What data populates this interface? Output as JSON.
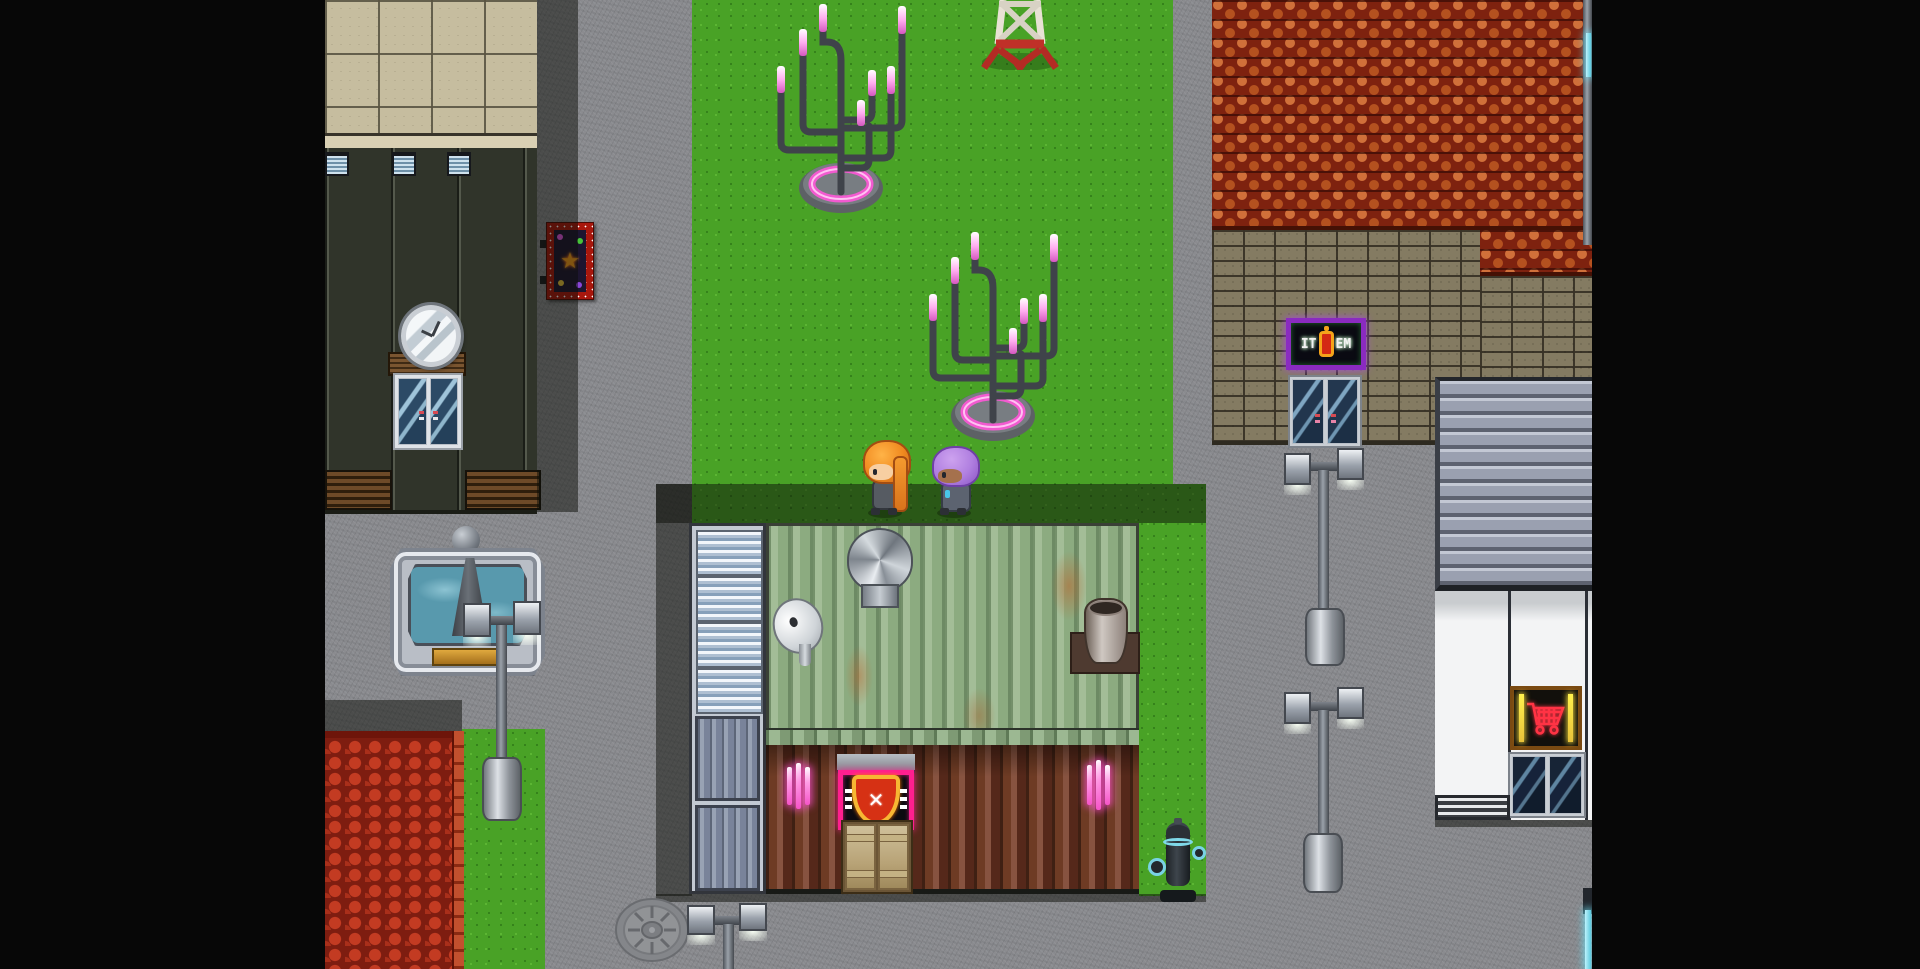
{
  "scene_title": "rpg-town-street-scene",
  "viewport": {
    "left_px": 325,
    "width_px": 1267,
    "height_px": 969
  },
  "colors": {
    "letterbox": "#070707",
    "road": "#8a8b8f",
    "grass": "#49a226",
    "shadow": "rgba(12,14,8,0.5)",
    "tan_roof": "#c6bd9f",
    "dark_wall": "#30342a",
    "orange_roof": "#b4511f",
    "brick": "#847b62",
    "green_metal": "#93ae88",
    "rust_metal": "#5e3220",
    "red_roof": "#a02516",
    "awning": "#9aa0b0",
    "shop_wall": "#f3f4f5",
    "water": "#5899ad",
    "neon_pink": "#ff57d8",
    "neon_cyan": "#7fdef0",
    "neon_magenta": "#ff1f8f",
    "neon_red": "#ff3344",
    "neon_yellow": "#e8c23a",
    "neon_purple": "#8a2bc0"
  },
  "signs": {
    "item_shop": {
      "text_left": "IT",
      "text_right": "EM",
      "description": "neon item-shop sign with potion bottle"
    },
    "guild_banner": {
      "glyph": "✕",
      "description": "pink neon banner with orange shield and white X"
    },
    "billboard": {
      "glyph": "★",
      "description": "red dotted billboard with orange star"
    },
    "market": {
      "icon": "shopping-cart-icon",
      "description": "red neon cart sign with yellow tubes"
    }
  },
  "characters": [
    {
      "id": "orange-haired-girl",
      "hair_color": "#f08a1f",
      "skin_color": "#f7cfa2",
      "outfit_color": "#565b62"
    },
    {
      "id": "purple-haired-girl",
      "hair_color": "#b07fe0",
      "skin_color": "#a5714d",
      "outfit_color": "#5c6370"
    }
  ],
  "props": [
    "candelabra-street-light-1",
    "candelabra-street-light-2",
    "radio-tower",
    "fountain",
    "fountain-street-lamp",
    "double-street-lamp-upper",
    "double-street-lamp-lower",
    "double-street-lamp-bottom",
    "manhole-cover",
    "fire-hydrant",
    "turbine-roof-vent",
    "satellite-dish",
    "chimney-vent",
    "wall-clock",
    "cyan-neon-tube-edge"
  ]
}
